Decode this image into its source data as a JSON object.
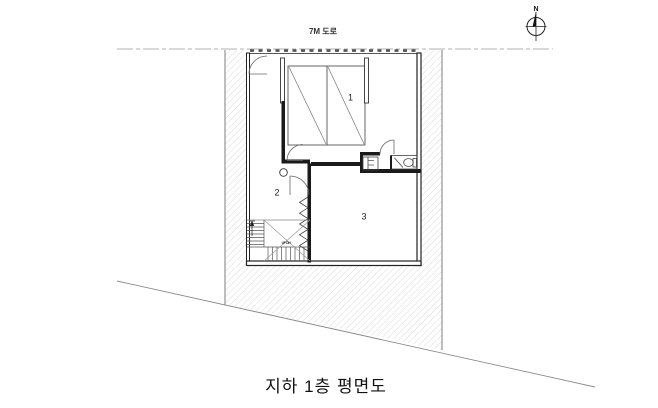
{
  "plan": {
    "title": "지하 1층 평면도",
    "road_label": "7M 도로",
    "compass_label": "N",
    "rooms": [
      {
        "label": "1"
      },
      {
        "label": "2"
      },
      {
        "label": "3"
      }
    ],
    "stair_note": "UP DN",
    "colors": {
      "line": "#1c1c1c",
      "wall_edge": "#222222",
      "hatch": "#c9c9c9",
      "road_dash": "#b0b0b0",
      "boundary": "#8a8a8a",
      "thin_line": "#555555"
    }
  }
}
